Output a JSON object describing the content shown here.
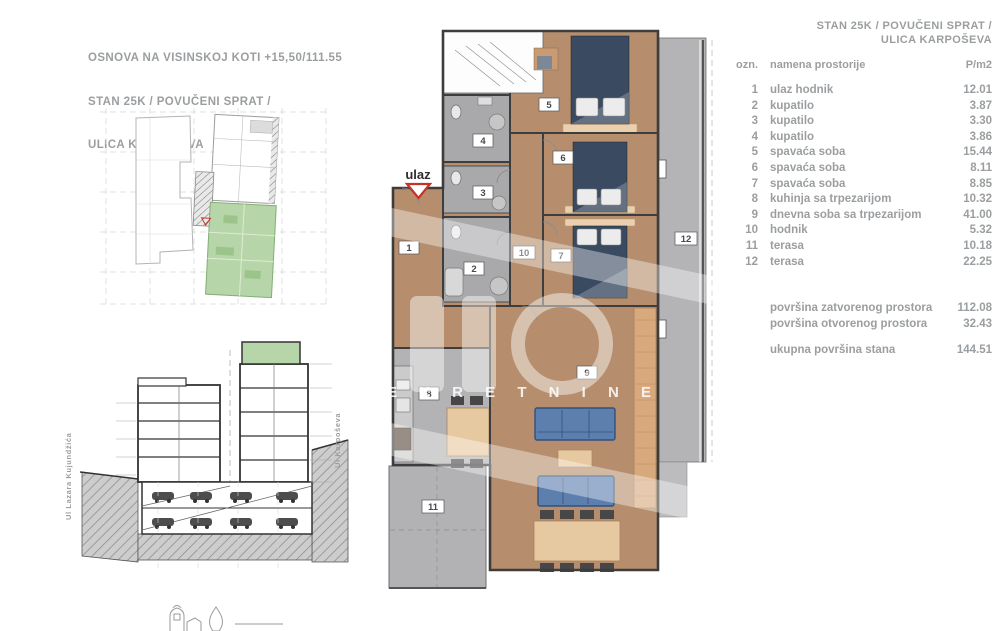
{
  "title_block": {
    "line1": "OSNOVA NA VISINSKOJ KOTI +15,50/111.55",
    "line2": "STAN 25K / POVUČENI SPRAT /",
    "line3": "ULICA KARPOŠEVA"
  },
  "panel": {
    "header_line1": "STAN 25K / POVUČENI SPRAT /",
    "header_line2": "ULICA KARPOŠEVA",
    "columns": {
      "ozn": "ozn.",
      "name": "namena prostorije",
      "area": "P/m2"
    },
    "rows": [
      {
        "ozn": "1",
        "name": "ulaz hodnik",
        "area": "12.01"
      },
      {
        "ozn": "2",
        "name": "kupatilo",
        "area": "3.87"
      },
      {
        "ozn": "3",
        "name": "kupatilo",
        "area": "3.30"
      },
      {
        "ozn": "4",
        "name": "kupatilo",
        "area": "3.86"
      },
      {
        "ozn": "5",
        "name": "spavaća soba",
        "area": "15.44"
      },
      {
        "ozn": "6",
        "name": "spavaća soba",
        "area": "8.11"
      },
      {
        "ozn": "7",
        "name": "spavaća soba",
        "area": "8.85"
      },
      {
        "ozn": "8",
        "name": "kuhinja sa trpezarijom",
        "area": "10.32"
      },
      {
        "ozn": "9",
        "name": "dnevna soba sa trpezarijom",
        "area": "41.00"
      },
      {
        "ozn": "10",
        "name": "hodnik",
        "area": "5.32"
      },
      {
        "ozn": "11",
        "name": "terasa",
        "area": "10.18"
      },
      {
        "ozn": "12",
        "name": "terasa",
        "area": "22.25"
      }
    ],
    "totals": [
      {
        "label": "površina zatvorenog prostora",
        "value": "112.08"
      },
      {
        "label": "površina otvorenog prostora",
        "value": "32.43"
      }
    ],
    "grand_total": {
      "label": "ukupna površina stana",
      "value": "144.51"
    }
  },
  "plan": {
    "entrance_label": "ulaz",
    "watermark_text": "E K R E T N I N E",
    "room_labels": [
      "1",
      "2",
      "3",
      "4",
      "5",
      "6",
      "7",
      "8",
      "9",
      "10",
      "11",
      "12"
    ]
  },
  "section": {
    "left_street": "Ul Lazara Kujundžića",
    "right_street": "Ul Karpoševa"
  },
  "colors": {
    "text_gray": "#9b9ea0",
    "floor_tan": "#b68e6d",
    "wet_room_gray": "#a9a9ab",
    "terrace_gray": "#b4b4b6",
    "bed_navy": "#394a61",
    "sofa_blue": "#5d7fae",
    "wood_light": "#e7c9a1",
    "highlight_green": "#b6d5a8",
    "ulaz_red": "#c43327"
  }
}
